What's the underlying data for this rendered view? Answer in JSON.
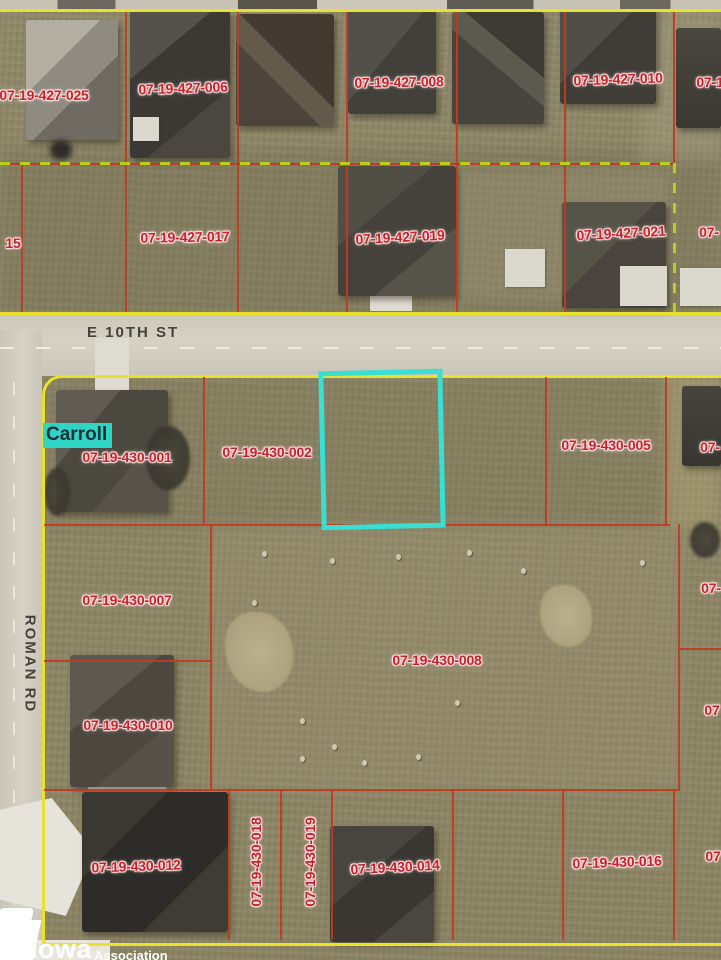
{
  "map": {
    "city_label": "Carroll",
    "streets": [
      {
        "name": "E 10TH ST"
      },
      {
        "name": "ROMAN RD"
      }
    ],
    "colors": {
      "parcel_line": "#c23a20",
      "boundary": "#e9e22c",
      "dash_green": "#bccf18",
      "label_red": "#c4232b",
      "highlight": "#38dfd2",
      "city_bg": "#2ed5c4"
    },
    "parcel_labels": [
      {
        "text": "07-19-427-025",
        "x": 44,
        "y": 95,
        "rot": 0
      },
      {
        "text": "07-19-427-006",
        "x": 183,
        "y": 88,
        "rot": -2
      },
      {
        "text": "07-19-427-008",
        "x": 399,
        "y": 82,
        "rot": -1
      },
      {
        "text": "07-19-427-010",
        "x": 618,
        "y": 79,
        "rot": -2
      },
      {
        "text": "07-1",
        "x": 710,
        "y": 82,
        "rot": 0
      },
      {
        "text": "15",
        "x": 13,
        "y": 243,
        "rot": 0
      },
      {
        "text": "07-19-427-017",
        "x": 185,
        "y": 237,
        "rot": -1
      },
      {
        "text": "07-19-427-019",
        "x": 400,
        "y": 237,
        "rot": -3
      },
      {
        "text": "07-19-427-021",
        "x": 621,
        "y": 233,
        "rot": -3
      },
      {
        "text": "07-",
        "x": 709,
        "y": 232,
        "rot": 0
      },
      {
        "text": "07-19-430-001",
        "x": 127,
        "y": 457,
        "rot": 0
      },
      {
        "text": "07-19-430-002",
        "x": 267,
        "y": 452,
        "rot": 0
      },
      {
        "text": "07-19-430-005",
        "x": 606,
        "y": 445,
        "rot": 0
      },
      {
        "text": "07-",
        "x": 710,
        "y": 447,
        "rot": 0
      },
      {
        "text": "07-19-430-007",
        "x": 127,
        "y": 600,
        "rot": 0
      },
      {
        "text": "07-19-430-008",
        "x": 437,
        "y": 660,
        "rot": 0
      },
      {
        "text": "07-",
        "x": 711,
        "y": 588,
        "rot": 0
      },
      {
        "text": "07",
        "x": 712,
        "y": 710,
        "rot": 0
      },
      {
        "text": "07-19-430-010",
        "x": 128,
        "y": 725,
        "rot": 0
      },
      {
        "text": "07-19-430-012",
        "x": 136,
        "y": 866,
        "rot": -2
      },
      {
        "text": "07-19-430-018",
        "x": 256,
        "y": 862,
        "rot": -90
      },
      {
        "text": "07-19-430-019",
        "x": 310,
        "y": 862,
        "rot": -90
      },
      {
        "text": "07-19-430-014",
        "x": 395,
        "y": 867,
        "rot": -3
      },
      {
        "text": "07-19-430-016",
        "x": 617,
        "y": 862,
        "rot": -2
      },
      {
        "text": "07",
        "x": 713,
        "y": 856,
        "rot": 0
      }
    ]
  },
  "watermark": {
    "brand": "Iowa",
    "tagline": "Association of"
  }
}
